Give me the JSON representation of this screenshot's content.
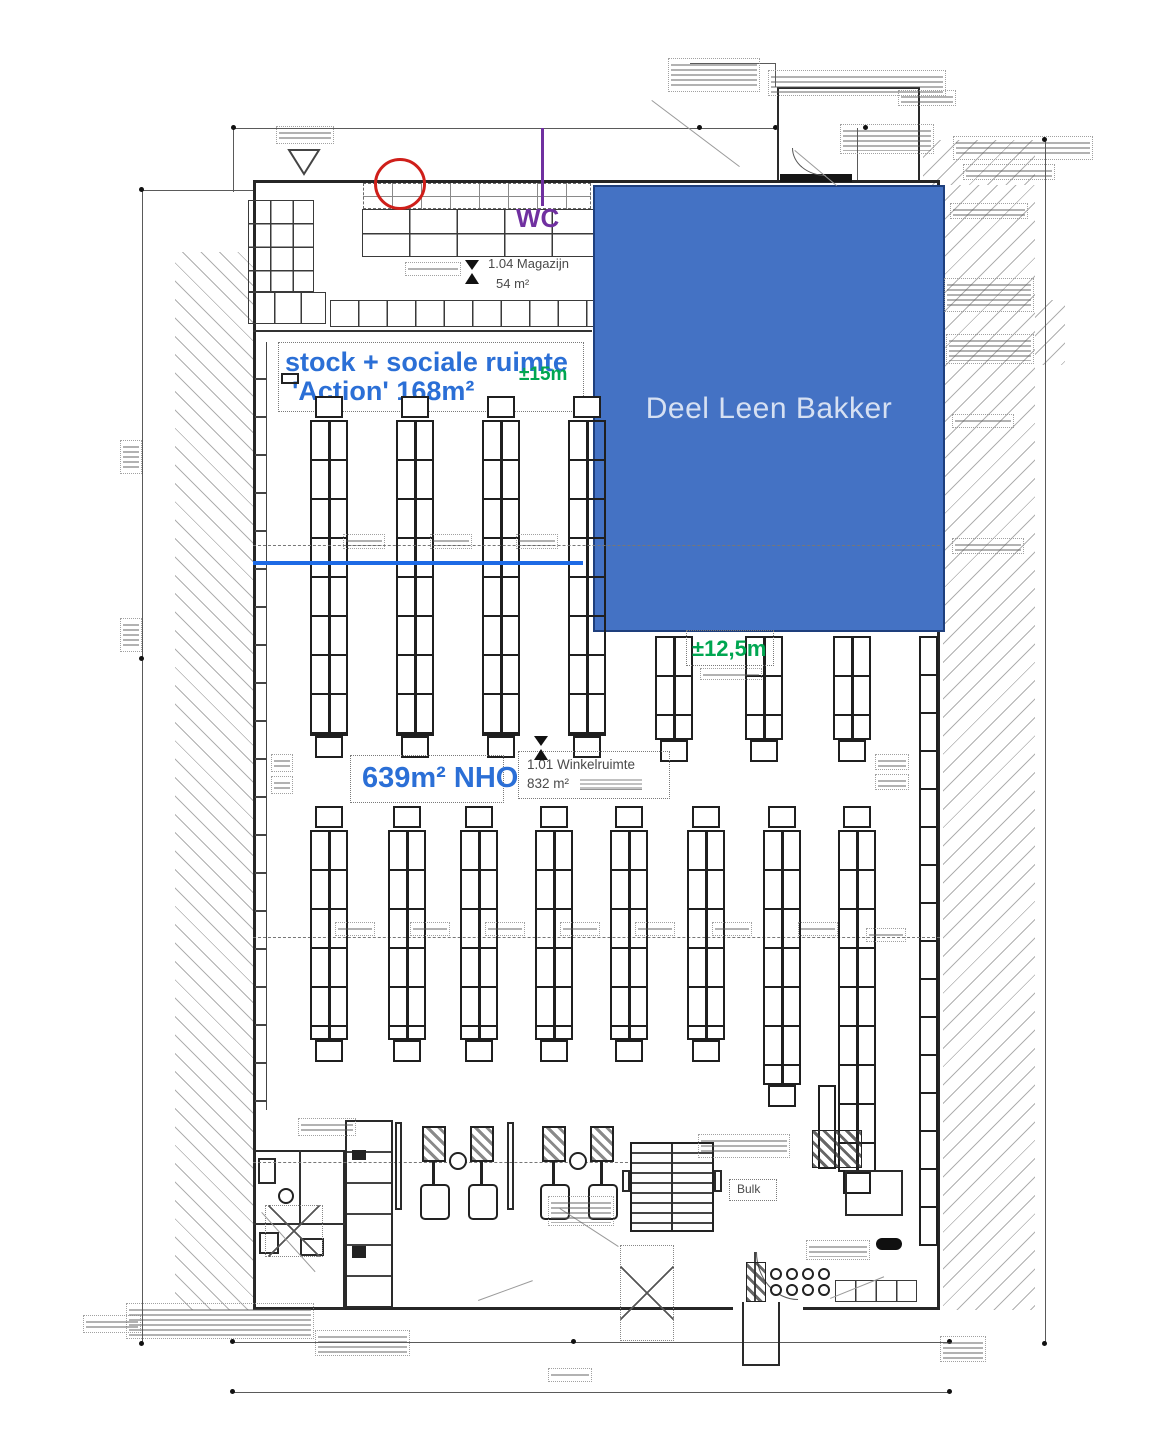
{
  "annotations": {
    "deel_leen_bakker": "Deel Leen Bakker",
    "stock_line1": "stock + sociale ruimte",
    "stock_line2": "'Action' 168m²",
    "dim15": "±15m",
    "dim125": "±12,5m",
    "nho": "639m² NHO",
    "winkel1": "1.01 Winkelruimte",
    "winkel2": "832 m²",
    "mag1": "1.04 Magazijn",
    "mag2": "54 m²",
    "wc": "WC",
    "bulk": "Bulk"
  },
  "colors": {
    "overlay_blue": "#4472C4",
    "annotation_blue": "#2B6FD6",
    "annotation_green": "#00A651",
    "annotation_purple": "#7030A0",
    "annotation_red": "#CF1F1A",
    "divider_blue": "#1D6AE5"
  }
}
